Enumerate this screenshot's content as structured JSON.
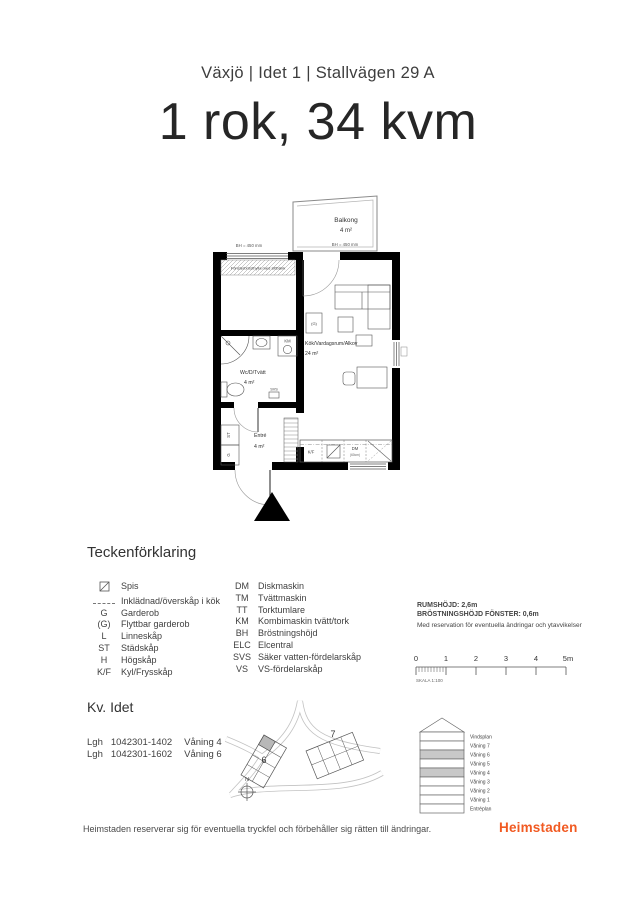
{
  "header": {
    "subtitle": "Växjö | Idet 1 | Stallvägen 29 A",
    "title": "1 rok, 34 kvm"
  },
  "plan": {
    "balcony_name": "Balkong",
    "balcony_area": "4 m²",
    "balcony_bh": "BH = 450 mm",
    "window_bh": "BH = 450 mm",
    "window_note": "Fönsterbrösthylla med sittbänk",
    "living_name": "Kök/Vardagsrum/Alkov",
    "living_area": "24 m²",
    "wc_name": "Wc/D/Tvätt",
    "wc_area": "4 m²",
    "entry_name": "Entré",
    "entry_area": "4 m²",
    "km": "KM",
    "svs": "SVS",
    "st": "ST",
    "g": "G",
    "gp": "(G)",
    "kf": "K/F",
    "dm": "DM",
    "dm_size": "(60cm)"
  },
  "legend": {
    "title": "Teckenförklaring",
    "col1": [
      {
        "abbr": "",
        "label": "Spis"
      },
      {
        "abbr": "",
        "label": "Inklädnad/överskåp i kök"
      },
      {
        "abbr": "G",
        "label": "Garderob"
      },
      {
        "abbr": "(G)",
        "label": "Flyttbar garderob"
      },
      {
        "abbr": "L",
        "label": "Linneskåp"
      },
      {
        "abbr": "ST",
        "label": "Städskåp"
      },
      {
        "abbr": "H",
        "label": "Högskåp"
      },
      {
        "abbr": "K/F",
        "label": "Kyl/Frysskåp"
      }
    ],
    "col2": [
      {
        "abbr": "DM",
        "label": "Diskmaskin"
      },
      {
        "abbr": "TM",
        "label": "Tvättmaskin"
      },
      {
        "abbr": "TT",
        "label": "Torktumlare"
      },
      {
        "abbr": "KM",
        "label": "Kombimaskin tvätt/tork"
      },
      {
        "abbr": "BH",
        "label": "Bröstningshöjd"
      },
      {
        "abbr": "ELC",
        "label": "Elcentral"
      },
      {
        "abbr": "SVS",
        "label": "Säker vatten-fördelarskåp"
      },
      {
        "abbr": "VS",
        "label": "VS-fördelarskåp"
      }
    ]
  },
  "info": {
    "line1": "RUMSHÖJD: 2,6m",
    "line2": "BRÖSTNINGSHÖJD FÖNSTER: 0,6m",
    "line3": "Med reservation för eventuella ändringar och ytavvikelser"
  },
  "scalebar": {
    "ticks": [
      "0",
      "1",
      "2",
      "3",
      "4",
      "5m"
    ],
    "label": "SKALA 1:100"
  },
  "block": {
    "title": "Kv. Idet",
    "apartments": [
      {
        "label": "Lgh",
        "id": "1042301-1402",
        "floor": "Våning 4"
      },
      {
        "label": "Lgh",
        "id": "1042301-1602",
        "floor": "Våning 6"
      }
    ],
    "site": {
      "b6": "6",
      "b7": "7",
      "compass": "N"
    },
    "elevation": {
      "floors": [
        {
          "label": "Vindsplan",
          "shaded": false
        },
        {
          "label": "Våning 7",
          "shaded": false
        },
        {
          "label": "Våning 6",
          "shaded": true
        },
        {
          "label": "Våning 5",
          "shaded": false
        },
        {
          "label": "Våning 4",
          "shaded": true
        },
        {
          "label": "Våning 3",
          "shaded": false
        },
        {
          "label": "Våning 2",
          "shaded": false
        },
        {
          "label": "Våning 1",
          "shaded": false
        },
        {
          "label": "Entréplan",
          "shaded": false
        }
      ]
    }
  },
  "footer": {
    "disclaimer": "Heimstaden reserverar sig för eventuella tryckfel och förbehåller sig rätten till ändringar.",
    "brand": "Heimstaden"
  },
  "colors": {
    "brand": "#F15A22",
    "floor_shade": "#C8C8C8"
  }
}
